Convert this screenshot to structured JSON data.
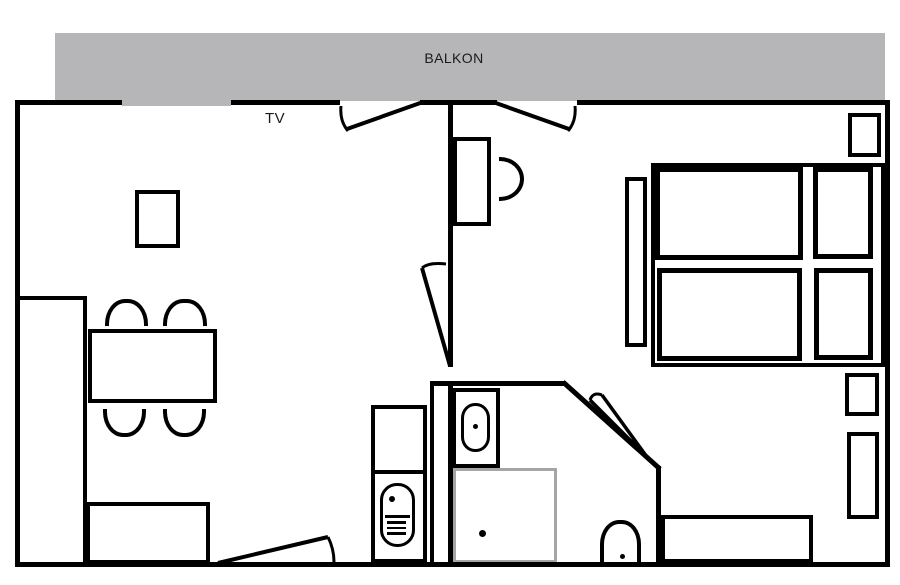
{
  "labels": {
    "balcony": "BALKON",
    "tv": "TV"
  },
  "colors": {
    "wall": "#000000",
    "balcony_fill": "#b6b6b8",
    "shower_outline": "#a5a5a5",
    "background": "#ffffff",
    "label_text": "#1a1a1a"
  }
}
